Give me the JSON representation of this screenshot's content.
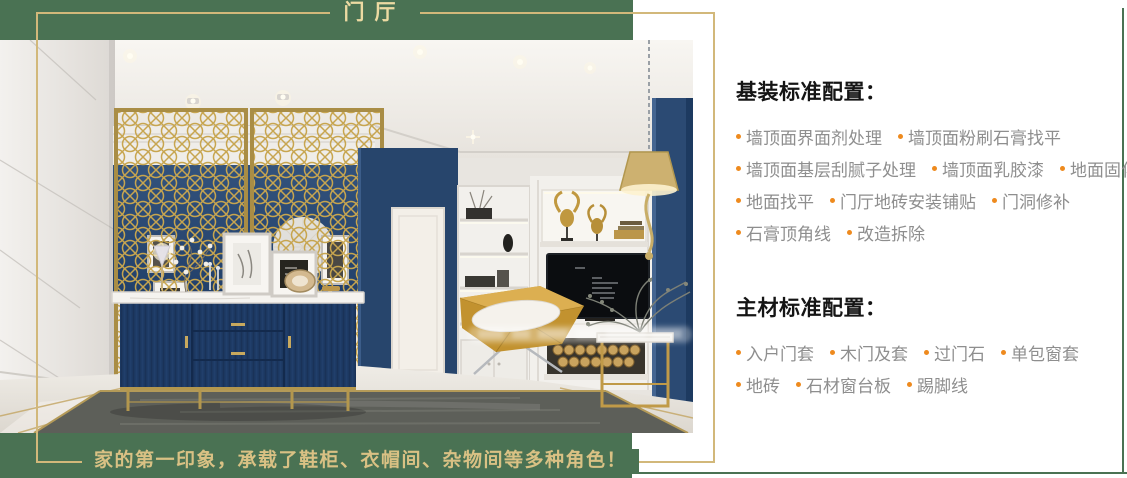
{
  "palette": {
    "green": "#4a7253",
    "gold": "#d2b87a",
    "orange": "#ee8a1e",
    "heading_text": "#151515",
    "item_text": "#8e8e8e",
    "title_gold": "#ecdaa2"
  },
  "header": {
    "title": "门厅"
  },
  "footer": {
    "caption": "家的第一印象，承载了鞋柜、衣帽间、杂物间等多种角色！"
  },
  "panel": {
    "basic": {
      "heading": "基装标准配置：",
      "rows": [
        {
          "items": [
            "墙顶面界面剂处理",
            "墙顶面粉刷石膏找平"
          ]
        },
        {
          "items": [
            "墙顶面基层刮腻子处理",
            "墙顶面乳胶漆",
            "地面固化"
          ]
        },
        {
          "items": [
            "地面找平",
            "门厅地砖安装铺贴",
            "门洞修补"
          ]
        },
        {
          "items": [
            "石膏顶角线",
            "改造拆除"
          ]
        }
      ]
    },
    "main": {
      "heading": "主材标准配置：",
      "rows": [
        {
          "items": [
            "入户门套",
            "木门及套",
            "过门石",
            "单包窗套"
          ]
        },
        {
          "items": [
            "地砖",
            "石材窗台板",
            "踢脚线"
          ]
        }
      ]
    }
  }
}
